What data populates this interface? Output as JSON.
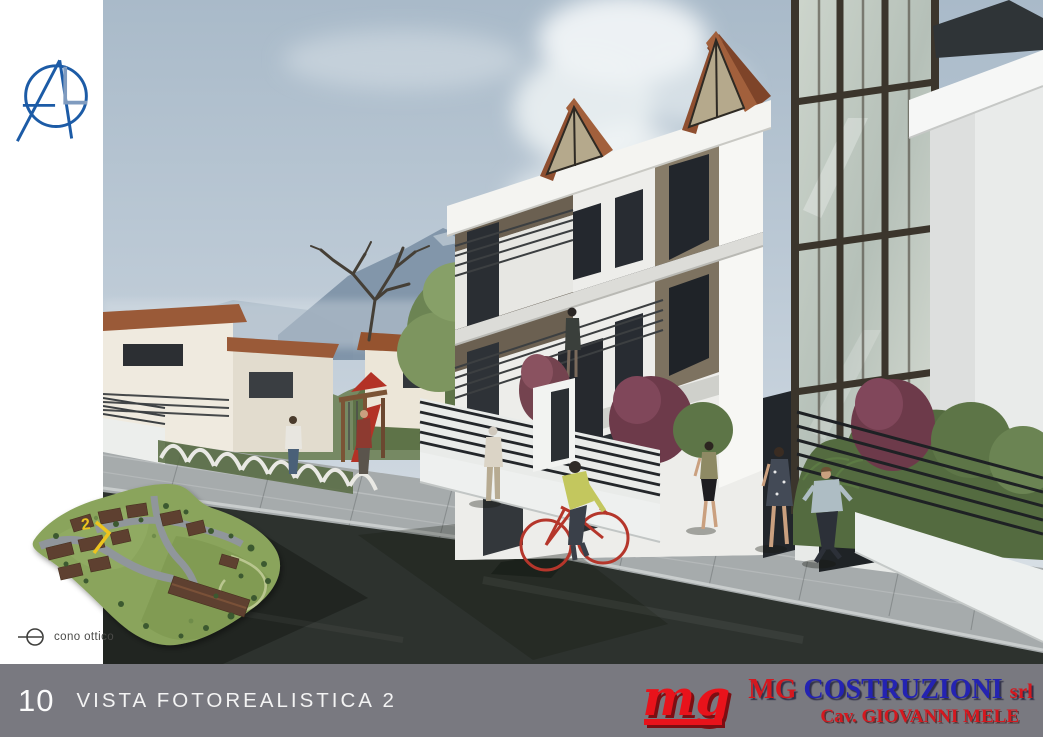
{
  "site_plan": {
    "marker_label": "2",
    "view_cone_label": "cono ottico"
  },
  "footer": {
    "page_number": "10",
    "title": "VISTA FOTOREALISTICA 2",
    "logo_monogram": "mg",
    "company_prefix": "MG",
    "company_name": "COSTRUZIONI",
    "company_suffix": "srl",
    "owner_line": "Cav. GIOVANNI MELE"
  },
  "colors": {
    "footer_bar": "#797980",
    "brand_red": "#d4181f",
    "brand_blue": "#2423b2",
    "architect_logo_blue": "#1c5ba6",
    "sky": "#b0bfce",
    "road": "#2d322e",
    "terracotta_roof": "#9a5636",
    "building_taupe": "#877c69",
    "site_plan_marker_yellow": "#edc41f"
  }
}
